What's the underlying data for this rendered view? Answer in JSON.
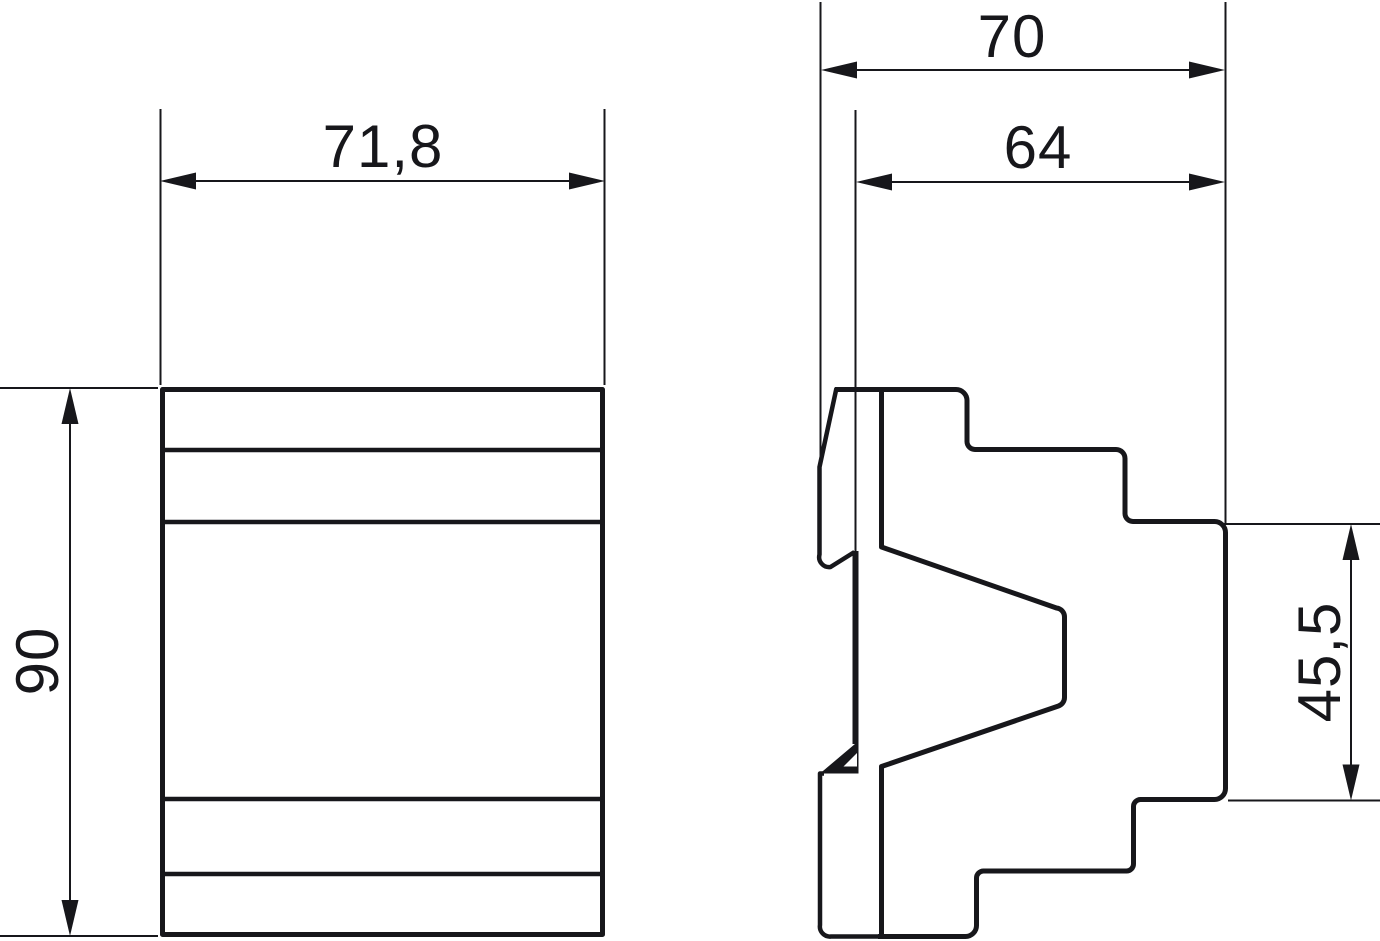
{
  "drawing": {
    "description": "Dimensional drawing, two orthographic views of a DIN-rail module",
    "front_view": {
      "width_label": "71,8",
      "height_label": "90"
    },
    "side_view": {
      "overall_depth_label": "70",
      "body_depth_label": "64",
      "front_section_height_label": "45,5"
    },
    "colors": {
      "line": "#17171b",
      "background": "#ffffff"
    }
  }
}
